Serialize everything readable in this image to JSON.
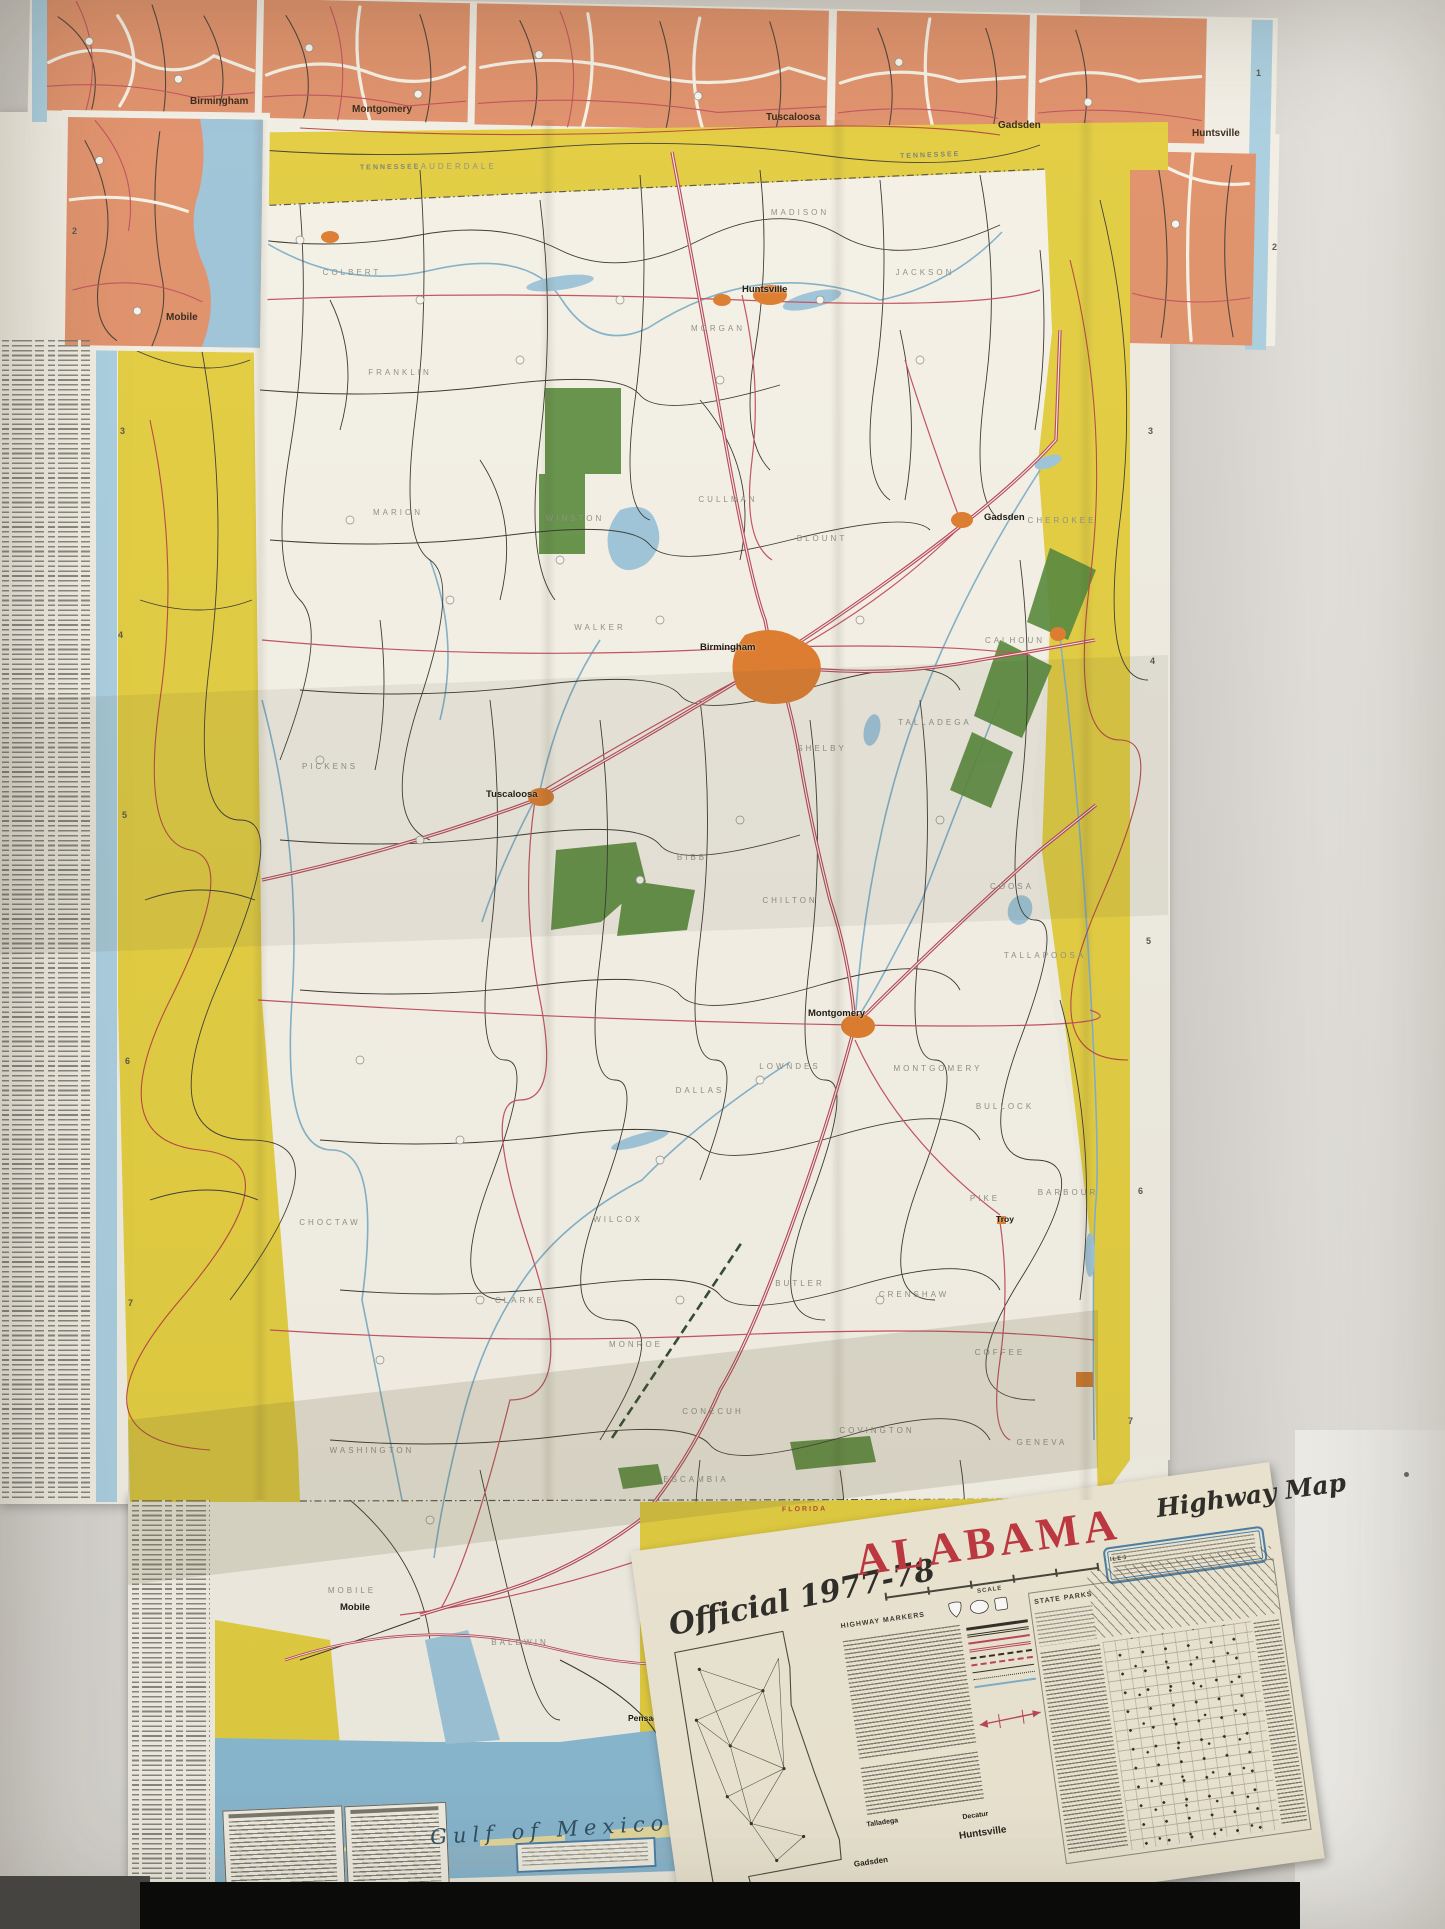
{
  "photo": {
    "title": {
      "prefix": "Official 1977-78",
      "state": "ALABAMA",
      "suffix": "Highway Map"
    },
    "top_insets": [
      "Birmingham",
      "Montgomery",
      "Tuscaloosa",
      "Gadsden",
      "Huntsville"
    ],
    "left_inset": "Mobile",
    "state_line_labels": {
      "north": "TENNESSEE",
      "south": "FLORIDA"
    },
    "gulf_label": "Gulf of Mexico",
    "cities": [
      "Huntsville",
      "Gadsden",
      "Birmingham",
      "Tuscaloosa",
      "Montgomery",
      "Troy",
      "Mobile",
      "Pensacola"
    ],
    "counties": [
      "LAUDERDALE",
      "COLBERT",
      "FRANKLIN",
      "MADISON",
      "JACKSON",
      "MORGAN",
      "MARION",
      "WINSTON",
      "CULLMAN",
      "BLOUNT",
      "CHEROKEE",
      "WALKER",
      "CALHOUN",
      "SHELBY",
      "TALLADEGA",
      "PICKENS",
      "BIBB",
      "CHILTON",
      "COOSA",
      "TALLAPOOSA",
      "DALLAS",
      "LOWNDES",
      "MONTGOMERY",
      "BULLOCK",
      "BARBOUR",
      "PIKE",
      "WILCOX",
      "MONROE",
      "BUTLER",
      "CRENSHAW",
      "CHOCTAW",
      "CLARKE",
      "WASHINGTON",
      "CONECUH",
      "COVINGTON",
      "ESCAMBIA",
      "COFFEE",
      "GENEVA",
      "MOBILE",
      "BALDWIN"
    ],
    "legend": {
      "state_parks_title": "STATE PARKS",
      "highway_markers_title": "HIGHWAY MARKERS",
      "scale_label": "SCALE",
      "miles_label": "MILES",
      "diagram_cities": [
        "Talladega",
        "Gadsden",
        "Decatur",
        "Huntsville"
      ]
    },
    "grid_numbers_left": [
      "2",
      "3",
      "4",
      "5",
      "6",
      "7"
    ],
    "grid_numbers_right": [
      "1",
      "2",
      "3",
      "4",
      "5",
      "6",
      "7"
    ],
    "colors": {
      "map_yellow": "#e2cd3f",
      "inset_orange": "#e0906a",
      "urban_orange": "#dd7a2c",
      "highway_red": "#b8455a",
      "water_blue": "#9dc4da",
      "forest_green": "#55893a",
      "title_red": "#bf3540"
    }
  }
}
